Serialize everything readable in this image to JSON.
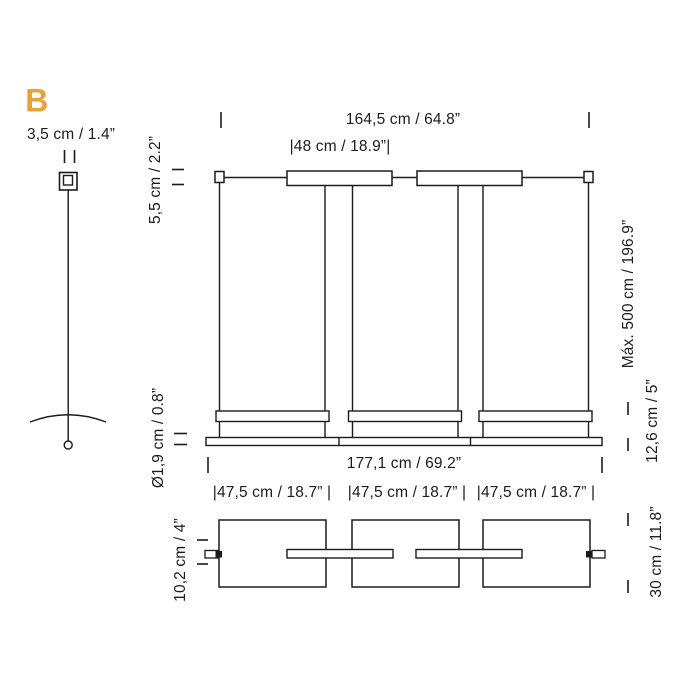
{
  "page": {
    "variant_label": "B"
  },
  "colors": {
    "accent_orange": "#E8A23B",
    "ink": "#1b1b1b",
    "background": "#ffffff"
  },
  "cable_view": {
    "dim_connector_width": "3,5 cm / 1.4”"
  },
  "front_view": {
    "dim_total_width": "164,5 cm / 64.8”",
    "dim_canopy_width": "|48 cm / 18.9”|",
    "dim_canopy_height": "5,5 cm / 2.2”",
    "dim_max_drop": "Máx. 500 cm / 196.9”",
    "dim_diffuser_height": "12,6 cm / 5”",
    "dim_stem_diameter": "Ø1,9 cm / 0.8”",
    "dim_base_width": "177,1 cm / 69.2”"
  },
  "top_view": {
    "shade_widths": [
      "|47,5 cm / 18.7” |",
      "|47,5 cm / 18.7” |",
      "|47,5 cm / 18.7” |"
    ],
    "dim_bar_depth": "10,2 cm / 4”",
    "dim_shade_depth": "30 cm / 11.8”"
  }
}
